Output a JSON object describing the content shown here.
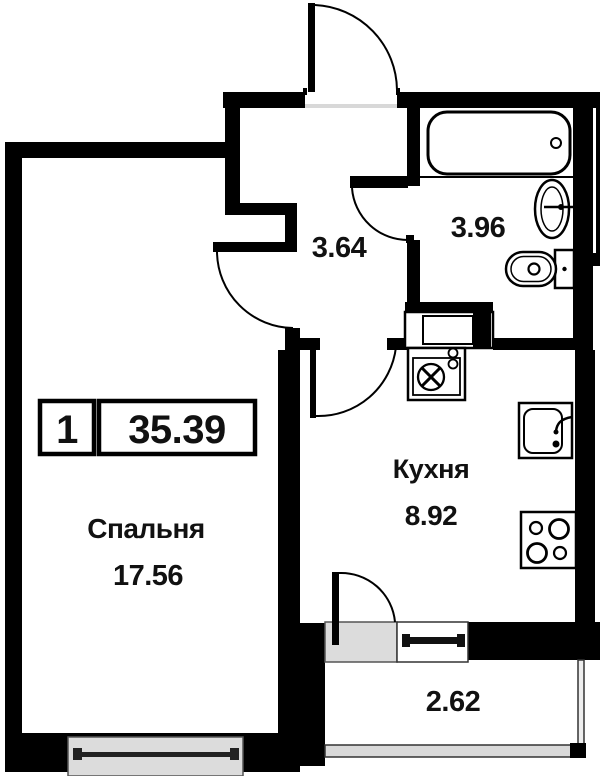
{
  "badge": {
    "room_count": "1",
    "total_area": "35.39"
  },
  "rooms": {
    "bedroom": {
      "name": "Спальня",
      "area": "17.56"
    },
    "kitchen": {
      "name": "Кухня",
      "area": "8.92"
    },
    "hallway": {
      "area": "3.64"
    },
    "bathroom": {
      "area": "3.96"
    },
    "balcony": {
      "area": "2.62"
    }
  },
  "colors": {
    "wall": "#000000",
    "background": "#ffffff",
    "window_fill": "#dcdcdc",
    "text": "#111111"
  },
  "icons": [
    "bathtub-icon",
    "washbasin-icon",
    "toilet-icon",
    "ventilation-box-icon",
    "kitchen-sink-icon",
    "stove-icon",
    "entrance-door-icon",
    "bedroom-door-icon",
    "bathroom-door-icon",
    "kitchen-door-icon",
    "balcony-door-icon",
    "bedroom-window-icon",
    "balcony-window-icon",
    "balcony-railing-icon"
  ]
}
